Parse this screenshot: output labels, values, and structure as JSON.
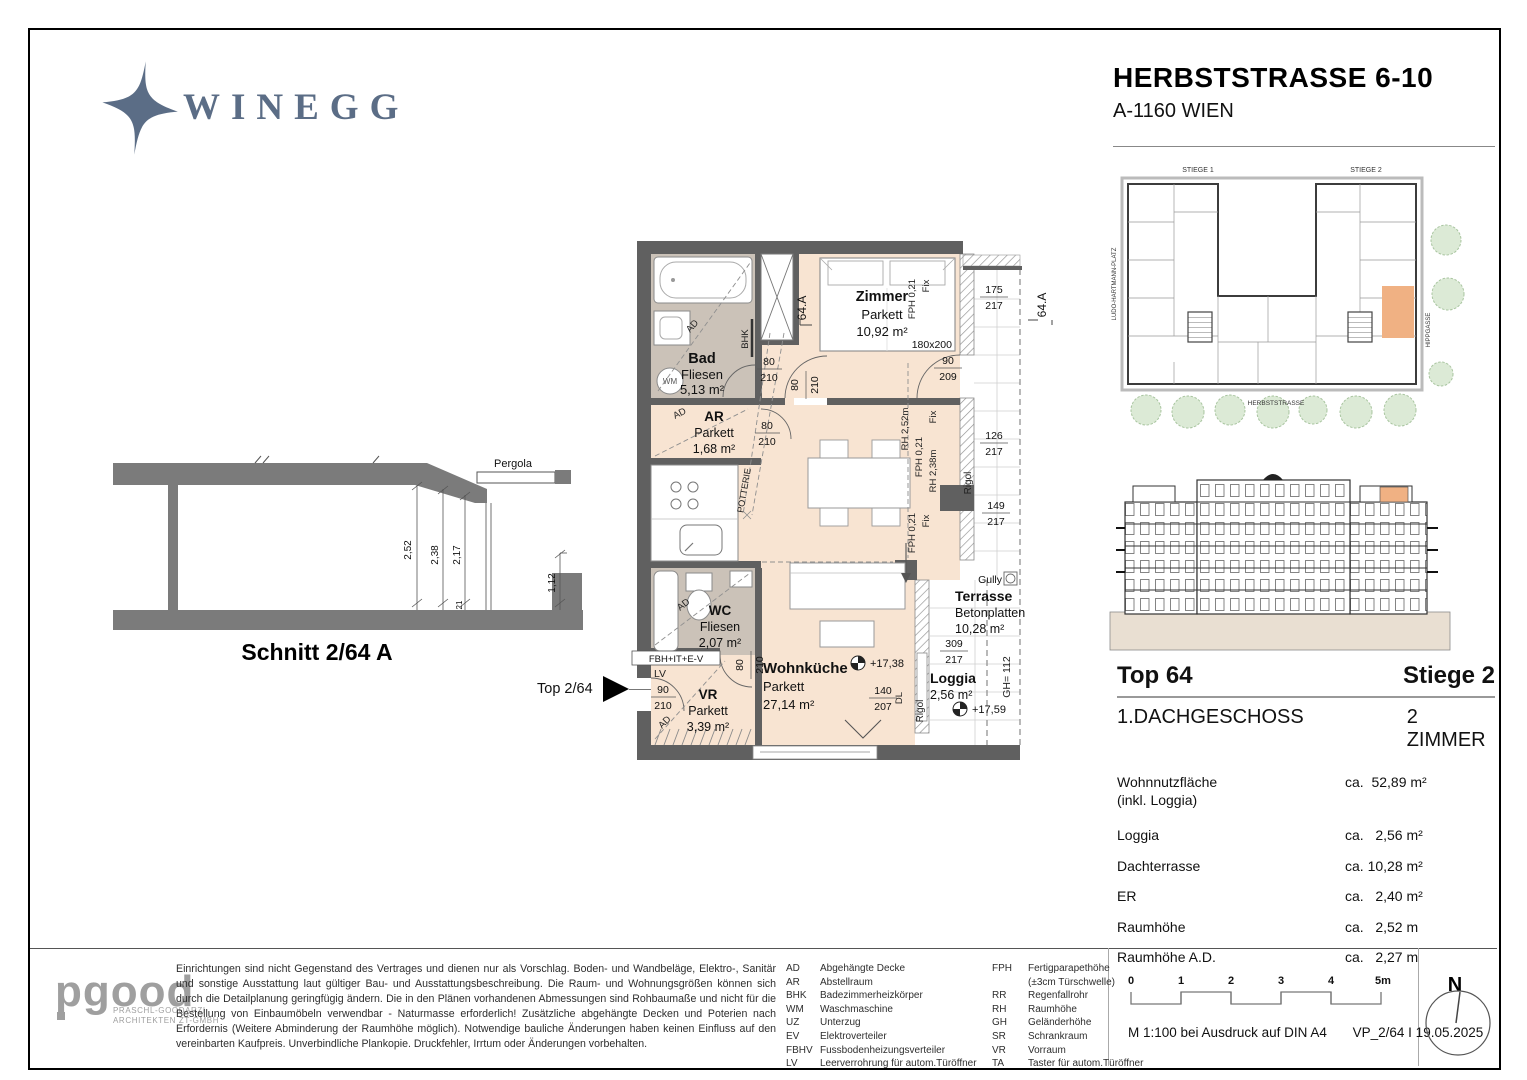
{
  "header": {
    "brand": "WINEGG",
    "title": "HERBSTSTRASSE 6-10",
    "subtitle": "A-1160 WIEN"
  },
  "site_plan": {
    "stiege1": "STIEGE 1",
    "stiege2": "STIEGE 2",
    "street_left": "LUDO-HARTMANN-PLATZ",
    "street_right": "HIPPGASSE",
    "street_bottom": "HERBSTSTRASSE",
    "highlight_color": "#f0b183"
  },
  "schnitt": {
    "caption": "Schnitt  2/64 A",
    "pergola": "Pergola",
    "d252": "2,52",
    "d238": "2,38",
    "d217": "2,17",
    "d112": "1,12",
    "d21": "21"
  },
  "entry": {
    "label": "Top 2/64"
  },
  "plan": {
    "rooms": {
      "bad": {
        "name": "Bad",
        "finish": "Fliesen",
        "area": "5,13 m²"
      },
      "zimmer": {
        "name": "Zimmer",
        "finish": "Parkett",
        "area": "10,92 m²",
        "bed": "180x200"
      },
      "ar": {
        "name": "AR",
        "finish": "Parkett",
        "area": "1,68 m²"
      },
      "wc": {
        "name": "WC",
        "finish": "Fliesen",
        "area": "2,07 m²"
      },
      "vr": {
        "name": "VR",
        "finish": "Parkett",
        "area": "3,39 m²"
      },
      "wohnkueche": {
        "name": "Wohnküche",
        "finish": "Parkett",
        "area": "27,14 m²"
      },
      "terrasse": {
        "name": "Terrasse",
        "finish": "Betonplatten",
        "area": "10,28 m²"
      },
      "loggia": {
        "name": "Loggia",
        "area": "2,56 m²"
      }
    },
    "marks": {
      "section_a": "64.A",
      "wm": "WM",
      "bhk": "BHK",
      "ad": "AD",
      "potterie": "POTTERIE",
      "lv": "LV",
      "fbh": "FBH+IT+E-V",
      "rigol": "Rigol",
      "gully": "Gully",
      "gh": "GH= 112",
      "dl": "DL",
      "level_wk": "+17,38",
      "level_loggia": "+17,59",
      "fph": "FPH 0,21",
      "fix": "Fix",
      "rh252": "RH 2,52m",
      "rh238": "RH 2,38m"
    },
    "dims": {
      "d80": "80",
      "d210": "210",
      "d90": "90",
      "d209": "209",
      "d175": "175",
      "d217": "217",
      "d126": "126",
      "d149": "149",
      "d309": "309",
      "d140": "140",
      "d207": "207"
    },
    "colors": {
      "parquet": "#f8e4d2",
      "tile": "#cbc2b8",
      "wall": "#606060"
    }
  },
  "details": {
    "top_label": "Top 64",
    "stiege_label": "Stiege 2",
    "floor_label": "1.DACHGESCHOSS",
    "rooms_label": "2 ZIMMER",
    "rows": [
      {
        "label": "Wohnnutzfläche",
        "label2": "(inkl. Loggia)",
        "value": "ca.  52,89 m²"
      },
      {
        "label": "Loggia",
        "value": "ca.   2,56 m²"
      },
      {
        "label": "Dachterrasse",
        "value": "ca. 10,28 m²"
      },
      {
        "label": "ER",
        "value": "ca.   2,40 m²"
      },
      {
        "label": "Raumhöhe",
        "value": "ca.   2,52 m"
      },
      {
        "label": "Raumhöhe A.D.",
        "value": "ca.   2,27 m"
      }
    ]
  },
  "footer": {
    "architect": {
      "word": "pgood",
      "sub1": "PRASCHL-GOODARZI",
      "sub2": "ARCHITEKTEN ZT-GMBH"
    },
    "disclaimer": "Einrichtungen sind nicht Gegenstand des Vertrages und dienen nur als Vorschlag. Boden- und Wandbeläge, Elektro-, Sanitär und sonstige Ausstattung laut gültiger Bau- und Ausstattungsbeschreibung. Die Raum- und Wohnungsgrößen können sich durch die Detailplanung geringfügig ändern. Die in den Plänen vorhandenen Abmessungen sind Rohbaumaße und nicht für die Bestellung von Einbaumöbeln verwendbar - Naturmasse erforderlich! Zusätzliche abgehängte Decken und Poterien nach Erfordernis (Weitere Abminderung der Raumhöhe möglich). Notwendige bauliche Änderungen haben keinen Einfluss auf den vereinbarten Kaufpreis. Unverbindliche Plankopie. Druckfehler, Irrtum oder Änderungen vorbehalten.",
    "legend_col1": [
      {
        "abbr": "AD",
        "desc": "Abgehängte Decke"
      },
      {
        "abbr": "AR",
        "desc": "Abstellraum"
      },
      {
        "abbr": "BHK",
        "desc": "Badezimmerheizkörper"
      },
      {
        "abbr": "WM",
        "desc": "Waschmaschine"
      },
      {
        "abbr": "UZ",
        "desc": "Unterzug"
      },
      {
        "abbr": "EV",
        "desc": "Elektroverteiler"
      },
      {
        "abbr": "FBHV",
        "desc": "Fussbodenheizungsverteiler"
      },
      {
        "abbr": "LV",
        "desc": "Leerverrohrung für autom.Türöffner"
      }
    ],
    "legend_col2": [
      {
        "abbr": "FPH",
        "desc": "Fertigparapethöhe",
        "desc2": "(±3cm Türschwelle)"
      },
      {
        "abbr": "RR",
        "desc": "Regenfallrohr"
      },
      {
        "abbr": "RH",
        "desc": "Raumhöhe"
      },
      {
        "abbr": "GH",
        "desc": "Geländerhöhe"
      },
      {
        "abbr": "SR",
        "desc": "Schrankraum"
      },
      {
        "abbr": "VR",
        "desc": "Vorraum"
      },
      {
        "abbr": "TA",
        "desc": "Taster für autom.Türöffner"
      }
    ],
    "scale": {
      "t0": "0",
      "t1": "1",
      "t2": "2",
      "t3": "3",
      "t4": "4",
      "t5": "5m",
      "note": "M 1:100 bei Ausdruck auf DIN A4",
      "ref": "VP_2/64 I 19.05.2025"
    },
    "north": "N"
  }
}
